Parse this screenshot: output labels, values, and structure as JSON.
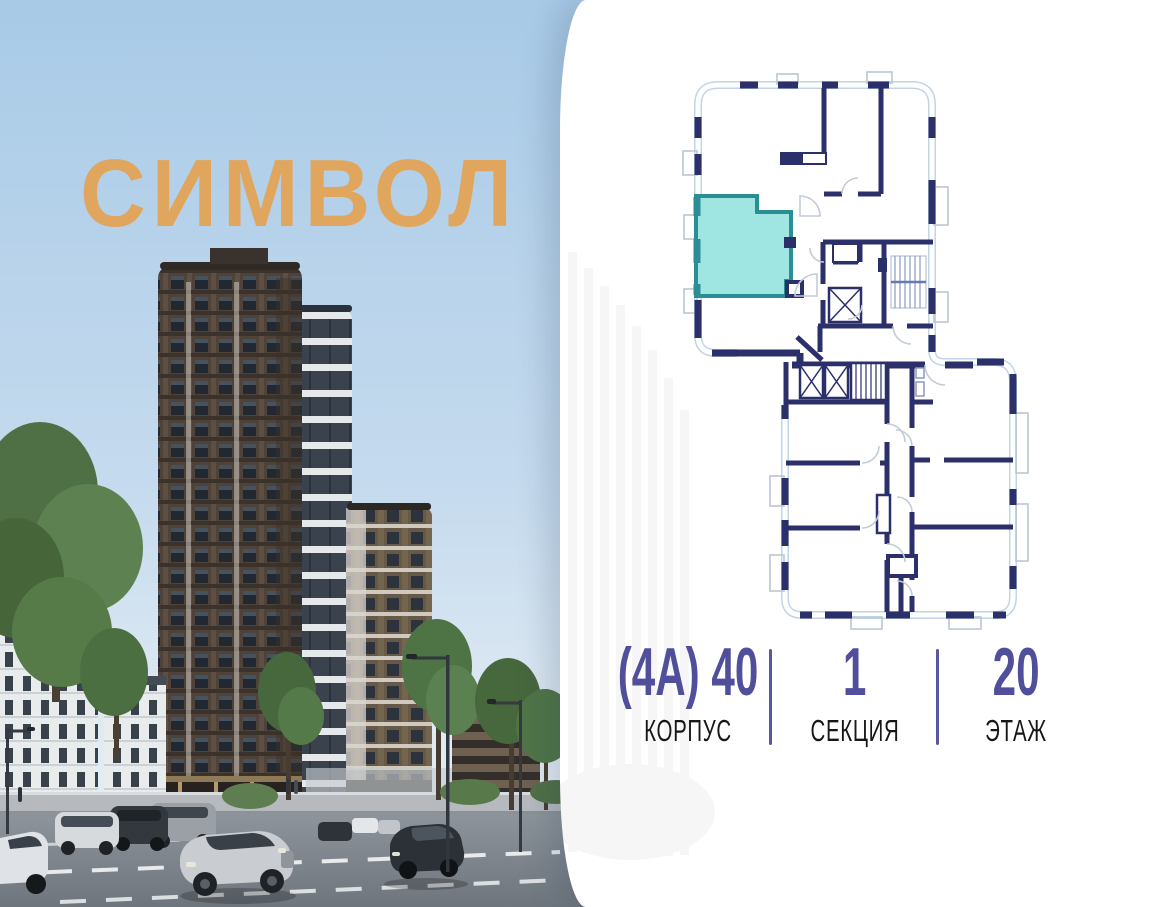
{
  "brand": {
    "logo_text": "СИМВОЛ",
    "logo_color": "#e0a65e"
  },
  "unit_info": {
    "items": [
      {
        "value": "(4А) 40",
        "label": "КОРПУС"
      },
      {
        "value": "1",
        "label": "СЕКЦИЯ"
      },
      {
        "value": "20",
        "label": "ЭТАЖ"
      }
    ],
    "accent_color": "#514f9c",
    "label_color": "#17171a"
  },
  "floor_plan": {
    "selected_unit_fill": "#9fe5e1",
    "selected_unit_stroke": "#2c8e95",
    "wall_color": "#2b2f6a",
    "window_band_color": "#c2d5e7",
    "door_arc_color": "#c2ccd6",
    "icons": {
      "elevator": "x-cross-shaft",
      "stairs": "hatched-steps"
    }
  }
}
